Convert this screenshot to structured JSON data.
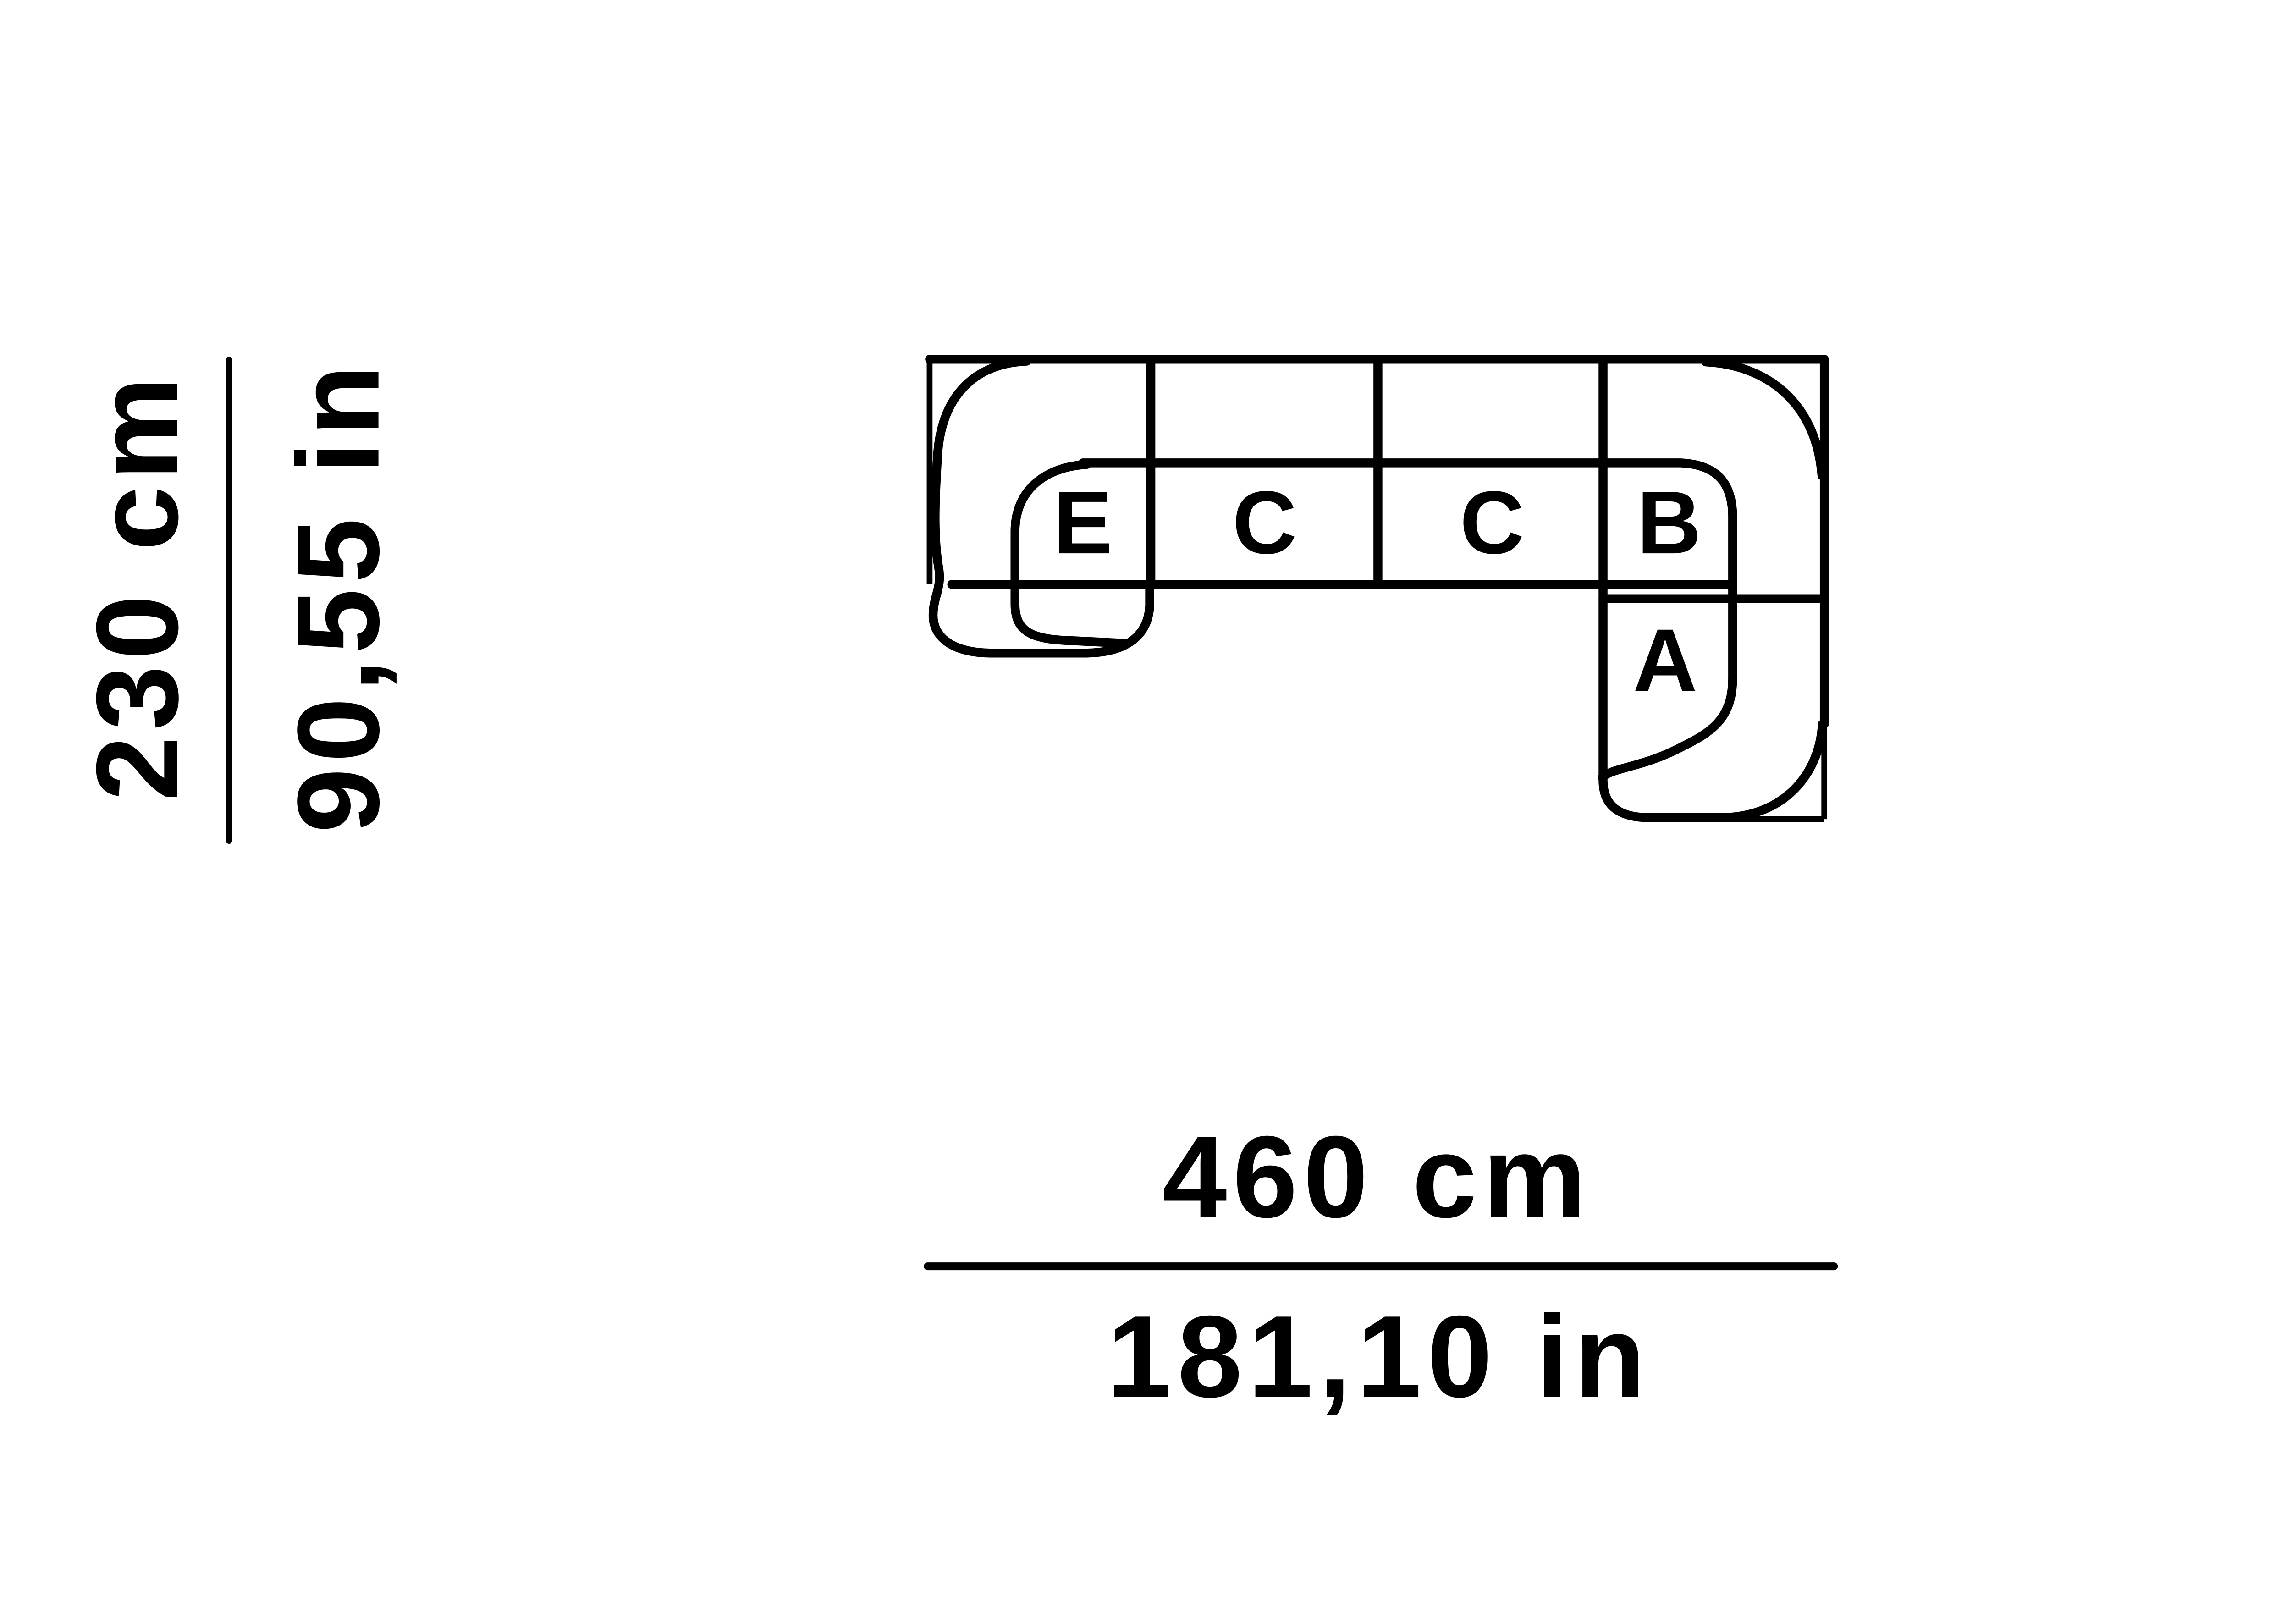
{
  "diagram": {
    "description": "Top view line drawing of a five module corner sofa configuration",
    "background": "#ffffff",
    "line_color": "#000000",
    "modules": [
      {
        "label": "E"
      },
      {
        "label": "C"
      },
      {
        "label": "C"
      },
      {
        "label": "B"
      },
      {
        "label": "A"
      }
    ],
    "dimensions": {
      "depth": {
        "metric": "230 cm",
        "imperial": "90,55 in"
      },
      "width": {
        "metric": "460 cm",
        "imperial": "181,10 in"
      }
    }
  }
}
